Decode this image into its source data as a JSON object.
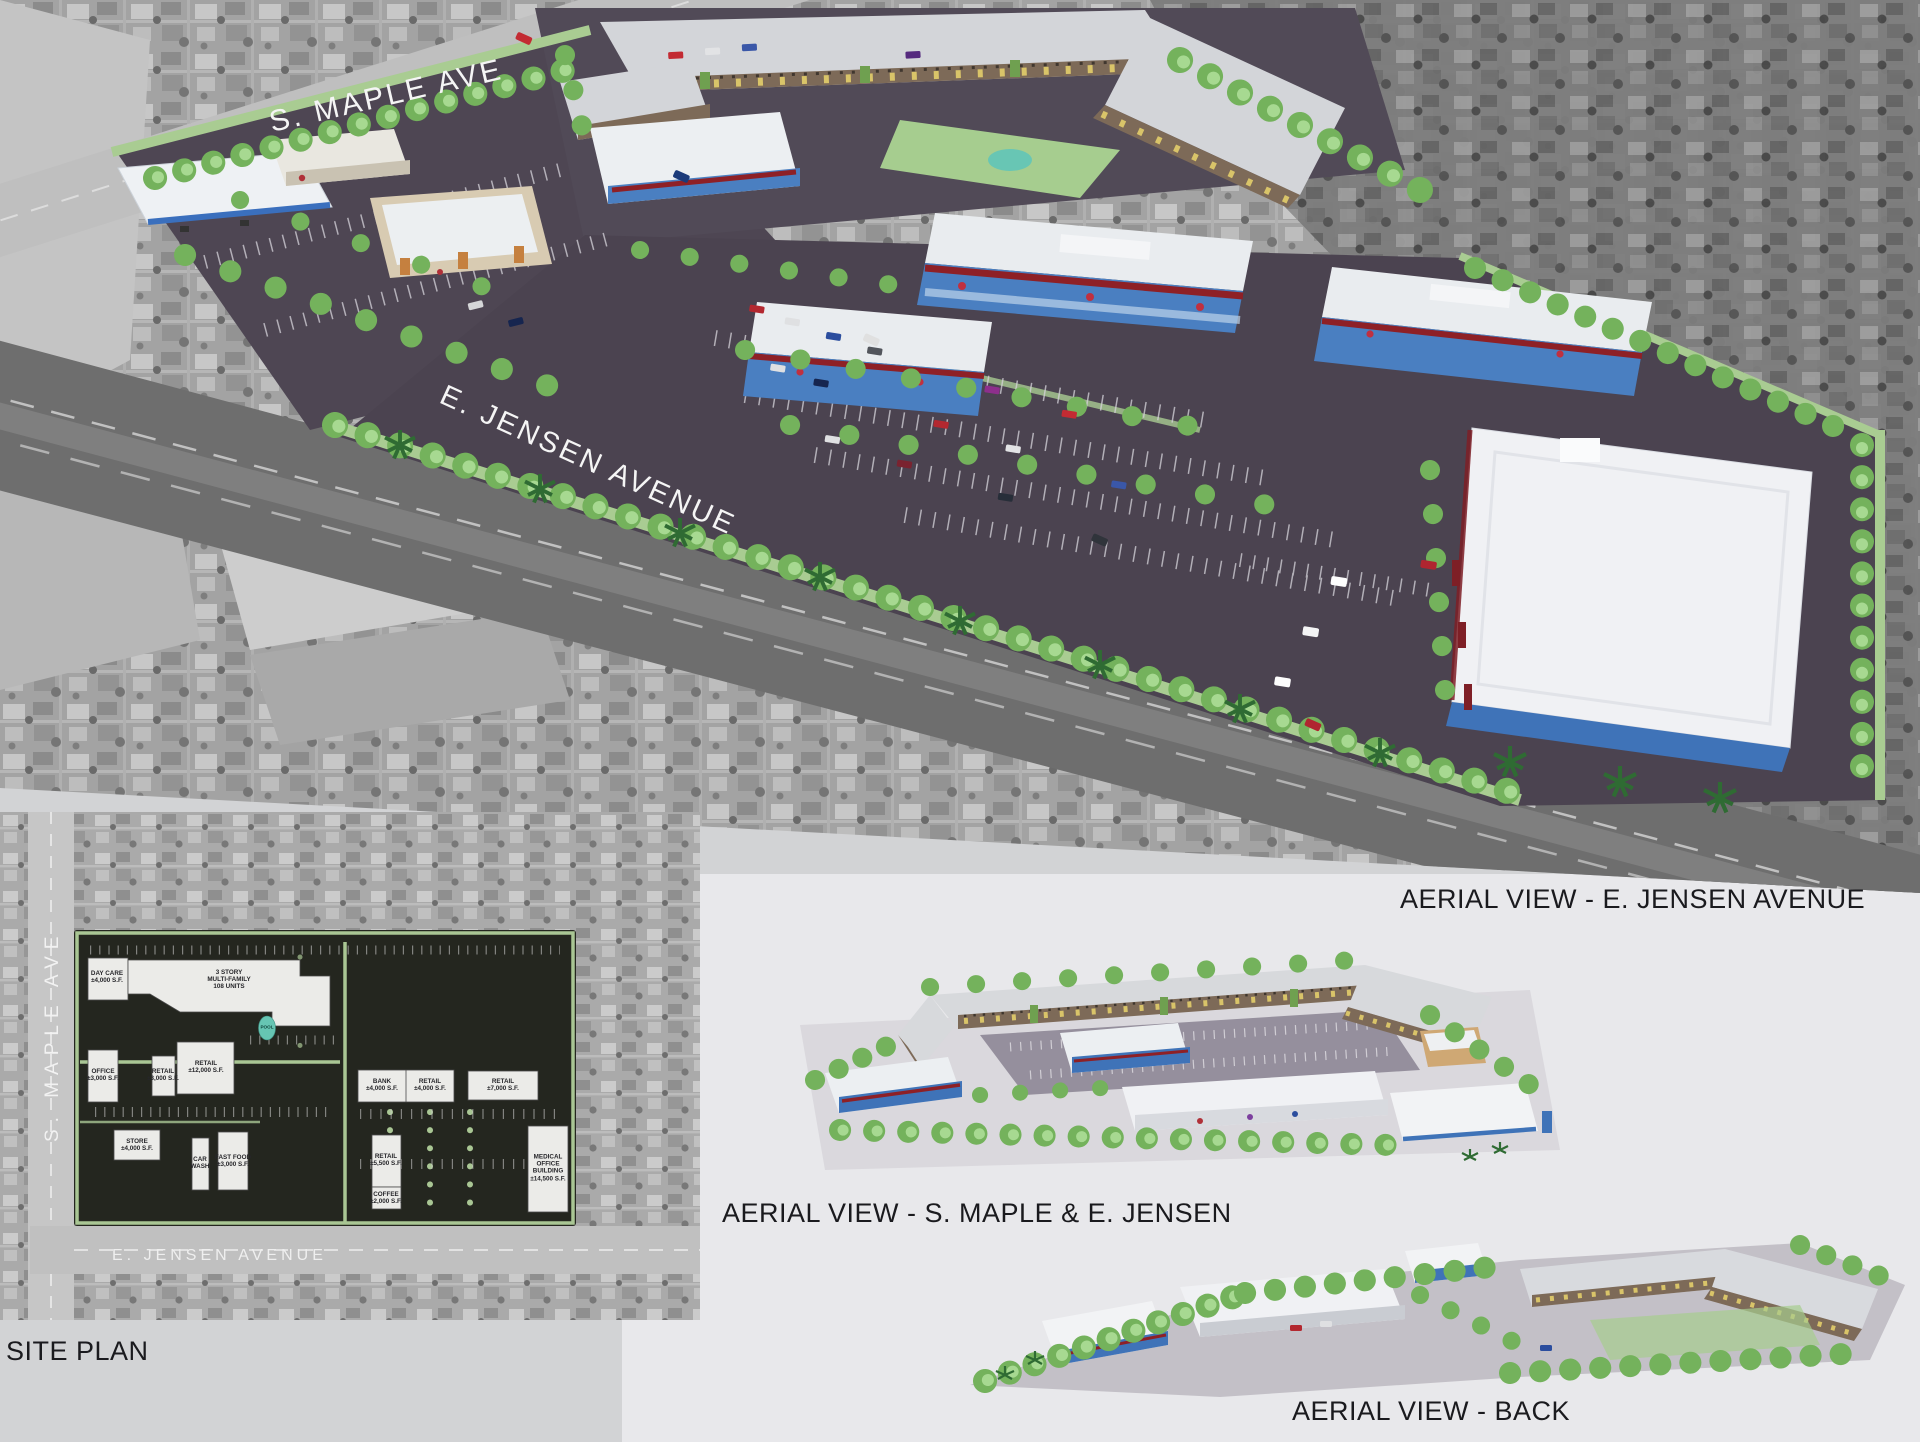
{
  "board": {
    "bg": "#d2d3d5",
    "sheet_bg": "#e8e8eb"
  },
  "captions": {
    "main": "AERIAL VIEW - E. JENSEN AVENUE",
    "site_plan": "SITE PLAN",
    "maple": "AERIAL VIEW - S. MAPLE & E. JENSEN",
    "back": "AERIAL VIEW - BACK"
  },
  "main_view": {
    "maple_road": "S. MAPLE AVE",
    "jensen_road": "E. JENSEN AVENUE"
  },
  "site_plan": {
    "maple_road": "S. MAPLE AVE",
    "jensen_road": "E. JENSEN AVENUE",
    "pool": "POOL",
    "buildings": [
      {
        "id": "day-care",
        "label": "DAY CARE\n±4,000 S.F."
      },
      {
        "id": "multifamily",
        "label": "3 STORY\nMULTI-FAMILY\n108 UNITS"
      },
      {
        "id": "office",
        "label": "OFFICE\n±3,000 S.F."
      },
      {
        "id": "retail-3000",
        "label": "RETAIL\n±3,000 S.F."
      },
      {
        "id": "retail-12000",
        "label": "RETAIL\n±12,000 S.F."
      },
      {
        "id": "bank",
        "label": "BANK\n±4,000 S.F."
      },
      {
        "id": "retail-4000",
        "label": "RETAIL\n±4,000 S.F."
      },
      {
        "id": "retail-7000",
        "label": "RETAIL\n±7,000 S.F."
      },
      {
        "id": "retail-5500",
        "label": "RETAIL\n±5,500 S.F."
      },
      {
        "id": "coffee",
        "label": "COFFEE\n±2,000 S.F."
      },
      {
        "id": "medical",
        "label": "MEDICAL\nOFFICE\nBUILDING\n±14,500 S.F."
      },
      {
        "id": "store",
        "label": "STORE\n±4,000 S.F."
      },
      {
        "id": "car-wash",
        "label": "CAR\nWASH"
      },
      {
        "id": "fast-food",
        "label": "FAST FOOD\n±3,000 S.F."
      }
    ]
  },
  "colors": {
    "retail_blue": "#4a7fc1",
    "awning_red": "#8e2026",
    "apartment_brown": "#7d6a58",
    "accent_yellow": "#d9c469",
    "accent_green": "#6fa050",
    "tree_green": "#74b25c",
    "landscape_green": "#a9cc92",
    "pool_teal": "#66c5b3",
    "asphalt": "#4b4350",
    "roof_white": "#eff0f3"
  }
}
